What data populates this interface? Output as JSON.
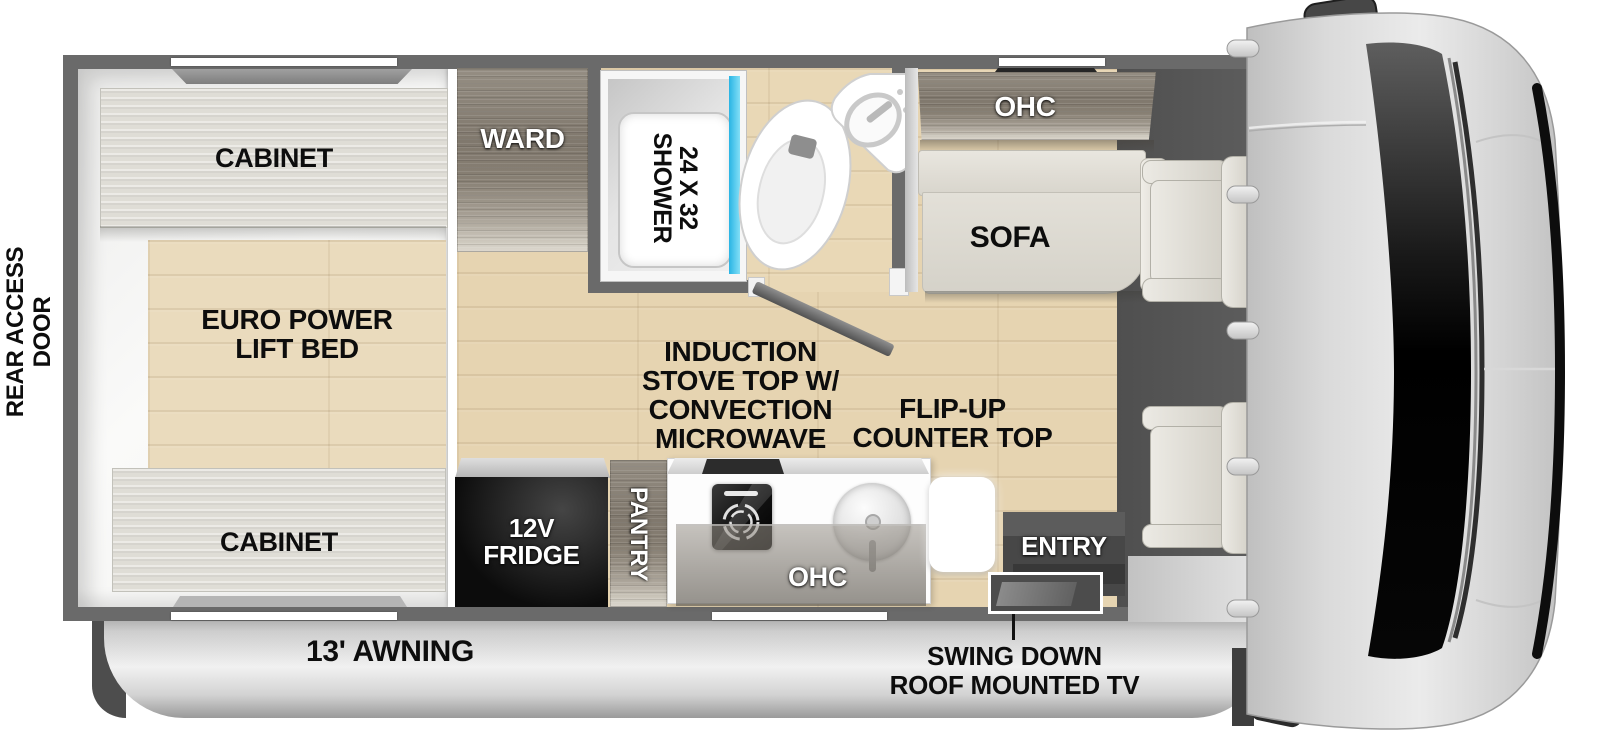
{
  "diagram": {
    "exterior": {
      "rear_access_door": {
        "lines": [
          "REAR ACCESS",
          "DOOR"
        ]
      },
      "awning": {
        "label": "13' AWNING"
      },
      "tv_note": {
        "lines": [
          "SWING DOWN",
          "ROOF MOUNTED TV"
        ]
      }
    },
    "bedroom": {
      "cabinet_top": "CABINET",
      "bed": {
        "lines": [
          "EURO POWER",
          "LIFT BED"
        ]
      },
      "cabinet_bottom": "CABINET"
    },
    "wardrobe": {
      "label": "WARD"
    },
    "bathroom": {
      "shower": {
        "lines": [
          "24 X 32",
          "SHOWER"
        ]
      }
    },
    "living": {
      "ohc": "OHC",
      "sofa": "SOFA"
    },
    "kitchen": {
      "stove_note": {
        "lines": [
          "INDUCTION",
          "STOVE TOP W/",
          "CONVECTION",
          "MICROWAVE"
        ]
      },
      "counter_note": {
        "lines": [
          "FLIP-UP",
          "COUNTER TOP"
        ]
      },
      "fridge": {
        "lines": [
          "12V",
          "FRIDGE"
        ]
      },
      "pantry": "PANTRY",
      "ohc": "OHC",
      "entry": "ENTRY"
    },
    "colors": {
      "wall_gray": "#6a6a6a",
      "floor_wood_tan": "#e6d4b1",
      "cabinet_taupe": "#857d71",
      "cabinet_light": "#dfddd6",
      "upholstery_cream": "#e0ddd4",
      "shower_glass_cyan": "#3cc3ec",
      "fridge_black": "#0f0f0f",
      "awning_silver": "#cccccc",
      "entry_dark": "#474747"
    }
  }
}
